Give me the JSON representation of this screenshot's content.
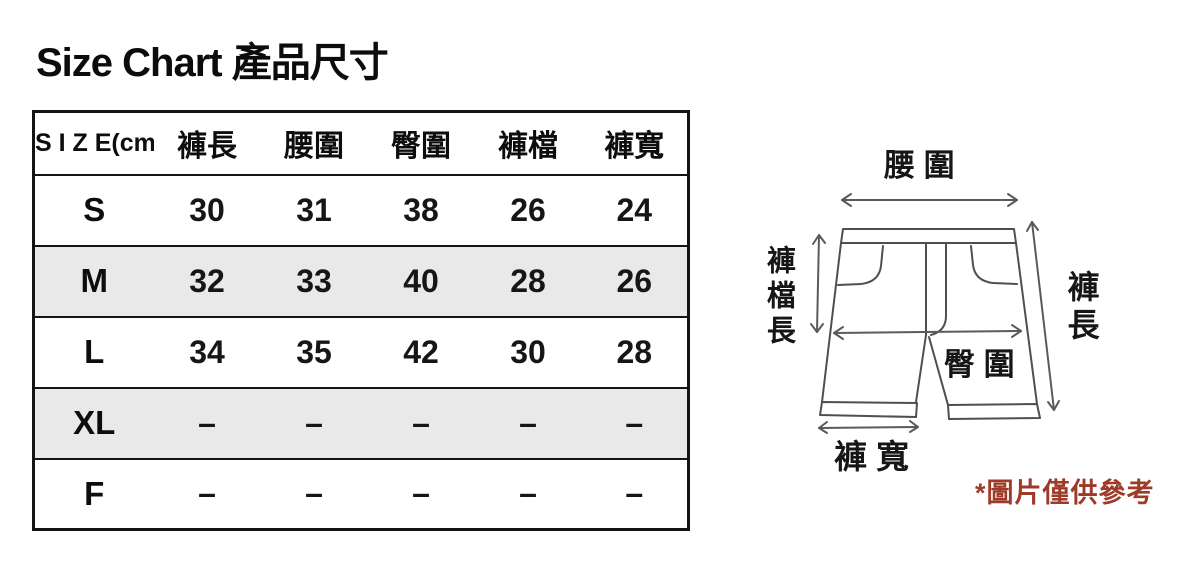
{
  "title": "Size Chart 產品尺寸",
  "table": {
    "size_header": "S I Z E(cm)",
    "columns": [
      "褲長",
      "腰圍",
      "臀圍",
      "褲檔",
      "褲寬"
    ],
    "rows": [
      {
        "size": "S",
        "values": [
          "30",
          "31",
          "38",
          "26",
          "24"
        ]
      },
      {
        "size": "M",
        "values": [
          "32",
          "33",
          "40",
          "28",
          "26"
        ]
      },
      {
        "size": "L",
        "values": [
          "34",
          "35",
          "42",
          "30",
          "28"
        ]
      },
      {
        "size": "XL",
        "values": [
          "–",
          "–",
          "–",
          "–",
          "–"
        ]
      },
      {
        "size": "F",
        "values": [
          "–",
          "–",
          "–",
          "–",
          "–"
        ]
      }
    ]
  },
  "diagram": {
    "waist_label": "腰 圍",
    "crotch_length_label": "褲檔長",
    "length_label": "褲長",
    "hip_label": "臀 圍",
    "leg_width_label": "褲 寬",
    "note": "*圖片僅供參考"
  },
  "colors": {
    "note_red": "#9e3a28",
    "shaded_row": "#e9e9e9",
    "table_border": "#141414",
    "diagram_line": "#4f4f4f"
  }
}
